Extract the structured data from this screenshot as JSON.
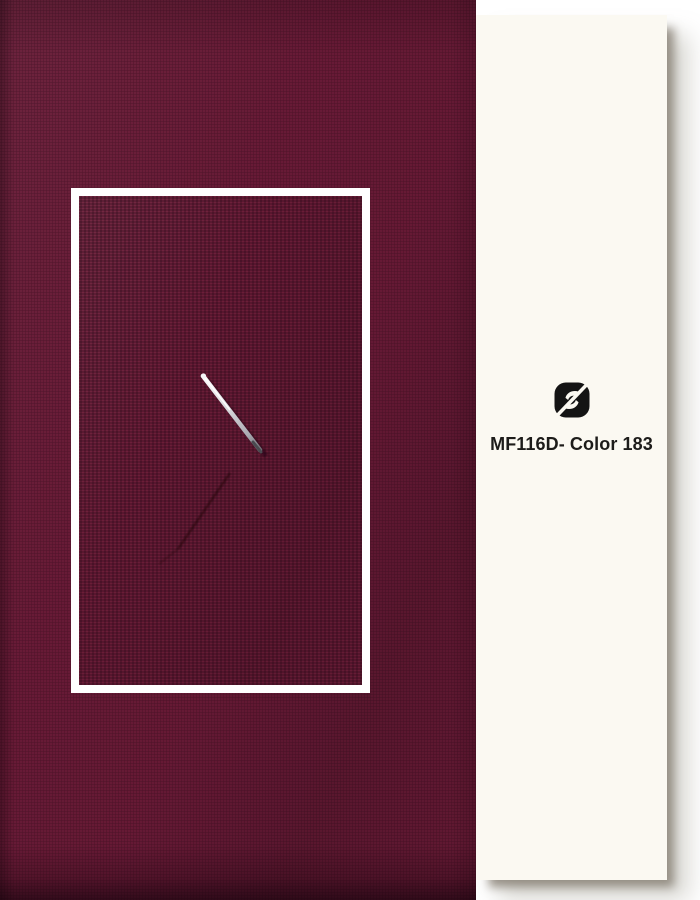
{
  "product": {
    "code_label": "MF116D- Color 183"
  },
  "brand": {
    "logo_icon": "fj-monogram-logo"
  },
  "colors": {
    "fabric_base": "#741e3c",
    "fabric_texture_dark": "#54102a",
    "inset_fabric_base": "#6f1e3a",
    "inset_frame_white": "#ffffff",
    "card_background": "#fbf9f2",
    "label_text": "#1d1c1a",
    "logo_black": "#141414",
    "needle_silver": "#d8d8dc"
  }
}
